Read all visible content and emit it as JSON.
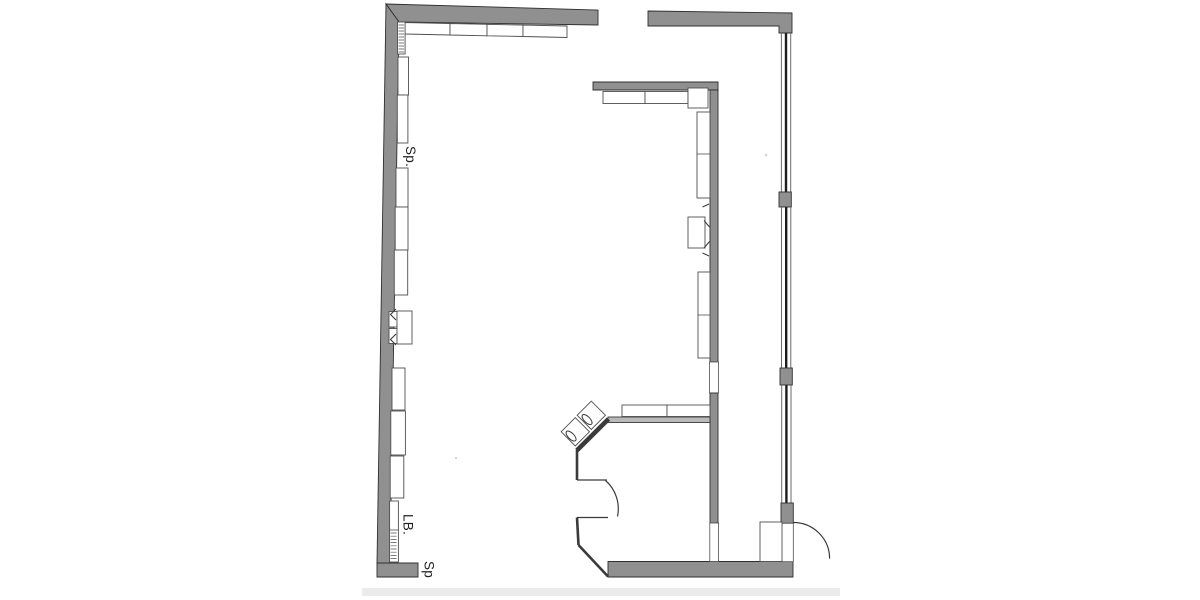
{
  "drawing": {
    "kind": "scanned architectural floor plan",
    "labels": [
      {
        "id": "sp_upper",
        "text": "Sp."
      },
      {
        "id": "lb",
        "text": "LB."
      },
      {
        "id": "sp_lower",
        "text": "Sp"
      }
    ],
    "colors": {
      "paper": "#ffffff",
      "wall_fill": "#909090",
      "wall_outline": "#2f2f2f",
      "line": "#3a3a3a",
      "counter_stroke": "#4f4f4f",
      "glass_thin": "#6a6a6a",
      "glass_core": "#1d1d1d",
      "thin_wall_fill": "#b9b9b9",
      "page_edge": "#ebebeb"
    }
  }
}
